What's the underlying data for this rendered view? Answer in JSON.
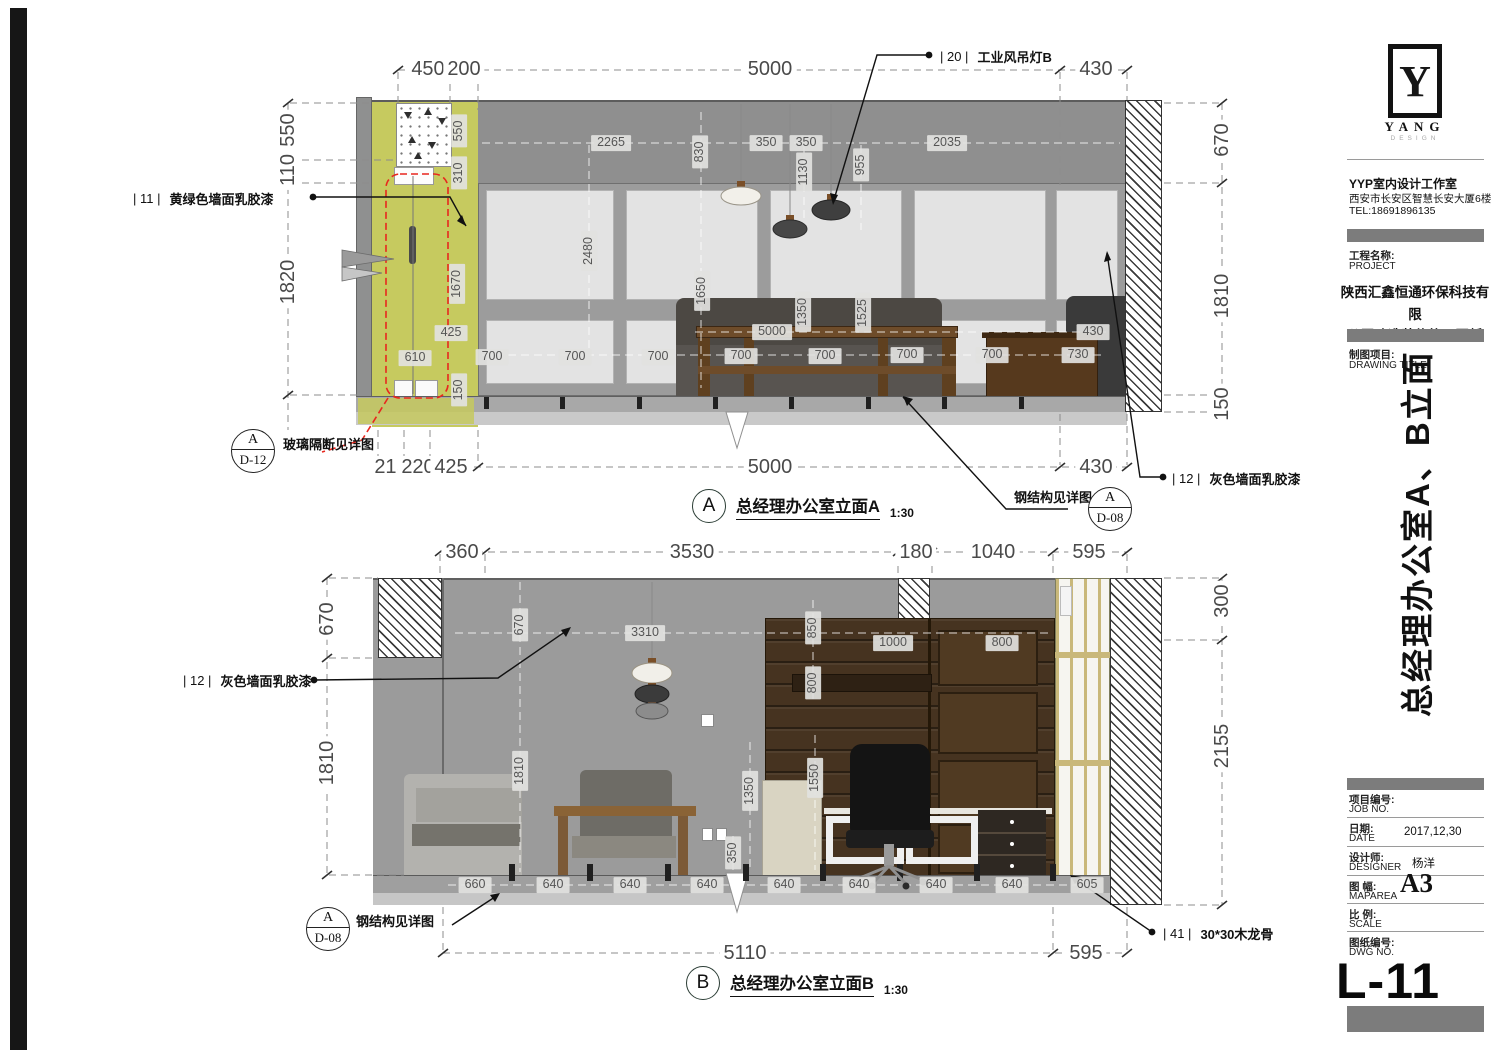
{
  "title_block": {
    "logo": {
      "mark": "Y",
      "name": "YANG",
      "sub": "DESIGN"
    },
    "studio": {
      "line1": "YYP室内设计工作室",
      "line2": "西安市长安区智慧长安大厦6楼",
      "line3": "TEL:18691896135"
    },
    "project": {
      "label_cn": "工程名称:",
      "label_en": "PROJECT",
      "name_line1": "陕西汇鑫恒通环保科技有限",
      "name_line2": "公司改造装修施工图纸"
    },
    "drawing": {
      "label_cn": "制图项目:",
      "label_en": "DRAWING TITLE",
      "sheet_title": "总经理办公室A、B立面"
    },
    "fields": {
      "job_cn": "项目编号:",
      "job_en": "JOB NO.",
      "date_cn": "日期:",
      "date_en": "DATE",
      "date_value": "2017,12,30",
      "designer_cn": "设计师:",
      "designer_en": "DESIGNER",
      "designer_value": "杨洋",
      "size_cn": "图 幅:",
      "size_en": "MAPAREA",
      "size_value": "A3",
      "scale_cn": "比 例:",
      "scale_en": "SCALE",
      "dwg_cn": "图纸编号:",
      "dwg_en": "DWG NO."
    },
    "sheet_number": "L-11"
  },
  "elevation_a": {
    "label": "A",
    "title": "总经理办公室立面A",
    "scale": "1:30",
    "callouts": {
      "paint11": {
        "tag": "| 11 |",
        "label": "黄绿色墙面乳胶漆"
      },
      "light20": {
        "tag": "| 20 |",
        "label": "工业风吊灯B"
      },
      "paint12": {
        "tag": "| 12 |",
        "label": "灰色墙面乳胶漆"
      },
      "glass_note": "玻璃隔断见详图",
      "steel_note": "钢结构见详图",
      "ref_d12": {
        "letter": "A",
        "sheet": "D-12"
      },
      "ref_d08": {
        "letter": "A",
        "sheet": "D-08"
      }
    },
    "dims": [
      {
        "t": "450",
        "x": 428,
        "y": 69,
        "s": "big"
      },
      {
        "t": "200",
        "x": 464,
        "y": 69,
        "s": "big"
      },
      {
        "t": "5000",
        "x": 770,
        "y": 69,
        "s": "big"
      },
      {
        "t": "430",
        "x": 1096,
        "y": 69,
        "s": "big"
      },
      {
        "t": "550",
        "x": 288,
        "y": 130,
        "s": "big",
        "v": true
      },
      {
        "t": "110",
        "x": 288,
        "y": 170,
        "s": "big",
        "v": true
      },
      {
        "t": "1820",
        "x": 288,
        "y": 282,
        "s": "big",
        "v": true
      },
      {
        "t": "670",
        "x": 1222,
        "y": 140,
        "s": "big",
        "v": true
      },
      {
        "t": "1810",
        "x": 1222,
        "y": 296,
        "s": "big",
        "v": true
      },
      {
        "t": "150",
        "x": 1222,
        "y": 404,
        "s": "big",
        "v": true
      },
      {
        "t": "215",
        "x": 391,
        "y": 467,
        "s": "big"
      },
      {
        "t": "220",
        "x": 418,
        "y": 467,
        "s": "big"
      },
      {
        "t": "425",
        "x": 451,
        "y": 467,
        "s": "big"
      },
      {
        "t": "5000",
        "x": 770,
        "y": 467,
        "s": "big"
      },
      {
        "t": "430",
        "x": 1096,
        "y": 467,
        "s": "big"
      },
      {
        "t": "2265",
        "x": 611,
        "y": 143,
        "s": "pill"
      },
      {
        "t": "830",
        "x": 700,
        "y": 152,
        "s": "pill",
        "v": true
      },
      {
        "t": "350",
        "x": 766,
        "y": 143,
        "s": "pill"
      },
      {
        "t": "350",
        "x": 806,
        "y": 143,
        "s": "pill"
      },
      {
        "t": "1130",
        "x": 804,
        "y": 172,
        "s": "pill",
        "v": true
      },
      {
        "t": "955",
        "x": 861,
        "y": 165,
        "s": "pill",
        "v": true
      },
      {
        "t": "2035",
        "x": 947,
        "y": 143,
        "s": "pill"
      },
      {
        "t": "550",
        "x": 459,
        "y": 131,
        "s": "pill",
        "v": true
      },
      {
        "t": "310",
        "x": 459,
        "y": 173,
        "s": "pill",
        "v": true
      },
      {
        "t": "2480",
        "x": 589,
        "y": 251,
        "s": "pill",
        "v": true
      },
      {
        "t": "1670",
        "x": 457,
        "y": 284,
        "s": "pill",
        "v": true
      },
      {
        "t": "1650",
        "x": 702,
        "y": 291,
        "s": "pill",
        "v": true
      },
      {
        "t": "425",
        "x": 451,
        "y": 333,
        "s": "pill"
      },
      {
        "t": "610",
        "x": 415,
        "y": 358,
        "s": "pill"
      },
      {
        "t": "150",
        "x": 459,
        "y": 390,
        "s": "pill",
        "v": true
      },
      {
        "t": "5000",
        "x": 772,
        "y": 332,
        "s": "pill"
      },
      {
        "t": "1350",
        "x": 803,
        "y": 312,
        "s": "pill",
        "v": true
      },
      {
        "t": "1525",
        "x": 863,
        "y": 313,
        "s": "pill",
        "v": true
      },
      {
        "t": "700",
        "x": 492,
        "y": 357,
        "s": "pill"
      },
      {
        "t": "700",
        "x": 575,
        "y": 357,
        "s": "pill"
      },
      {
        "t": "700",
        "x": 658,
        "y": 357,
        "s": "pill"
      },
      {
        "t": "700",
        "x": 741,
        "y": 356,
        "s": "pill"
      },
      {
        "t": "700",
        "x": 825,
        "y": 356,
        "s": "pill"
      },
      {
        "t": "700",
        "x": 907,
        "y": 355,
        "s": "pill"
      },
      {
        "t": "700",
        "x": 992,
        "y": 355,
        "s": "pill"
      },
      {
        "t": "730",
        "x": 1078,
        "y": 355,
        "s": "pill"
      },
      {
        "t": "430",
        "x": 1093,
        "y": 332,
        "s": "pill"
      }
    ]
  },
  "elevation_b": {
    "label": "B",
    "title": "总经理办公室立面B",
    "scale": "1:30",
    "callouts": {
      "paint12": {
        "tag": "| 12 |",
        "label": "灰色墙面乳胶漆"
      },
      "steel_note": "钢结构见详图",
      "ref_d08": {
        "letter": "A",
        "sheet": "D-08"
      },
      "joist41": {
        "tag": "| 41 |",
        "label": "30*30木龙骨"
      }
    },
    "dims": [
      {
        "t": "360",
        "x": 462,
        "y": 552,
        "s": "big"
      },
      {
        "t": "3530",
        "x": 692,
        "y": 552,
        "s": "big"
      },
      {
        "t": "180",
        "x": 916,
        "y": 552,
        "s": "big"
      },
      {
        "t": "1040",
        "x": 993,
        "y": 552,
        "s": "big"
      },
      {
        "t": "595",
        "x": 1089,
        "y": 552,
        "s": "big"
      },
      {
        "t": "670",
        "x": 327,
        "y": 619,
        "s": "big",
        "v": true
      },
      {
        "t": "1810",
        "x": 327,
        "y": 763,
        "s": "big",
        "v": true
      },
      {
        "t": "300",
        "x": 1222,
        "y": 601,
        "s": "big",
        "v": true
      },
      {
        "t": "2155",
        "x": 1222,
        "y": 746,
        "s": "big",
        "v": true
      },
      {
        "t": "5110",
        "x": 745,
        "y": 953,
        "s": "big"
      },
      {
        "t": "595",
        "x": 1086,
        "y": 953,
        "s": "big"
      },
      {
        "t": "670",
        "x": 520,
        "y": 625,
        "s": "pill",
        "v": true
      },
      {
        "t": "3310",
        "x": 645,
        "y": 633,
        "s": "pill"
      },
      {
        "t": "850",
        "x": 813,
        "y": 628,
        "s": "pill",
        "v": true
      },
      {
        "t": "800",
        "x": 813,
        "y": 683,
        "s": "pill",
        "v": true
      },
      {
        "t": "1000",
        "x": 893,
        "y": 643,
        "s": "pill"
      },
      {
        "t": "800",
        "x": 1002,
        "y": 643,
        "s": "pill"
      },
      {
        "t": "1810",
        "x": 520,
        "y": 771,
        "s": "pill",
        "v": true
      },
      {
        "t": "1350",
        "x": 750,
        "y": 791,
        "s": "pill",
        "v": true
      },
      {
        "t": "1550",
        "x": 815,
        "y": 778,
        "s": "pill",
        "v": true
      },
      {
        "t": "350",
        "x": 733,
        "y": 853,
        "s": "pill",
        "v": true
      },
      {
        "t": "660",
        "x": 475,
        "y": 885,
        "s": "pill"
      },
      {
        "t": "640",
        "x": 553,
        "y": 885,
        "s": "pill"
      },
      {
        "t": "640",
        "x": 630,
        "y": 885,
        "s": "pill"
      },
      {
        "t": "640",
        "x": 707,
        "y": 885,
        "s": "pill"
      },
      {
        "t": "640",
        "x": 784,
        "y": 885,
        "s": "pill"
      },
      {
        "t": "640",
        "x": 859,
        "y": 885,
        "s": "pill"
      },
      {
        "t": "640",
        "x": 936,
        "y": 885,
        "s": "pill"
      },
      {
        "t": "640",
        "x": 1012,
        "y": 885,
        "s": "pill"
      },
      {
        "t": "605",
        "x": 1087,
        "y": 885,
        "s": "pill"
      }
    ]
  }
}
